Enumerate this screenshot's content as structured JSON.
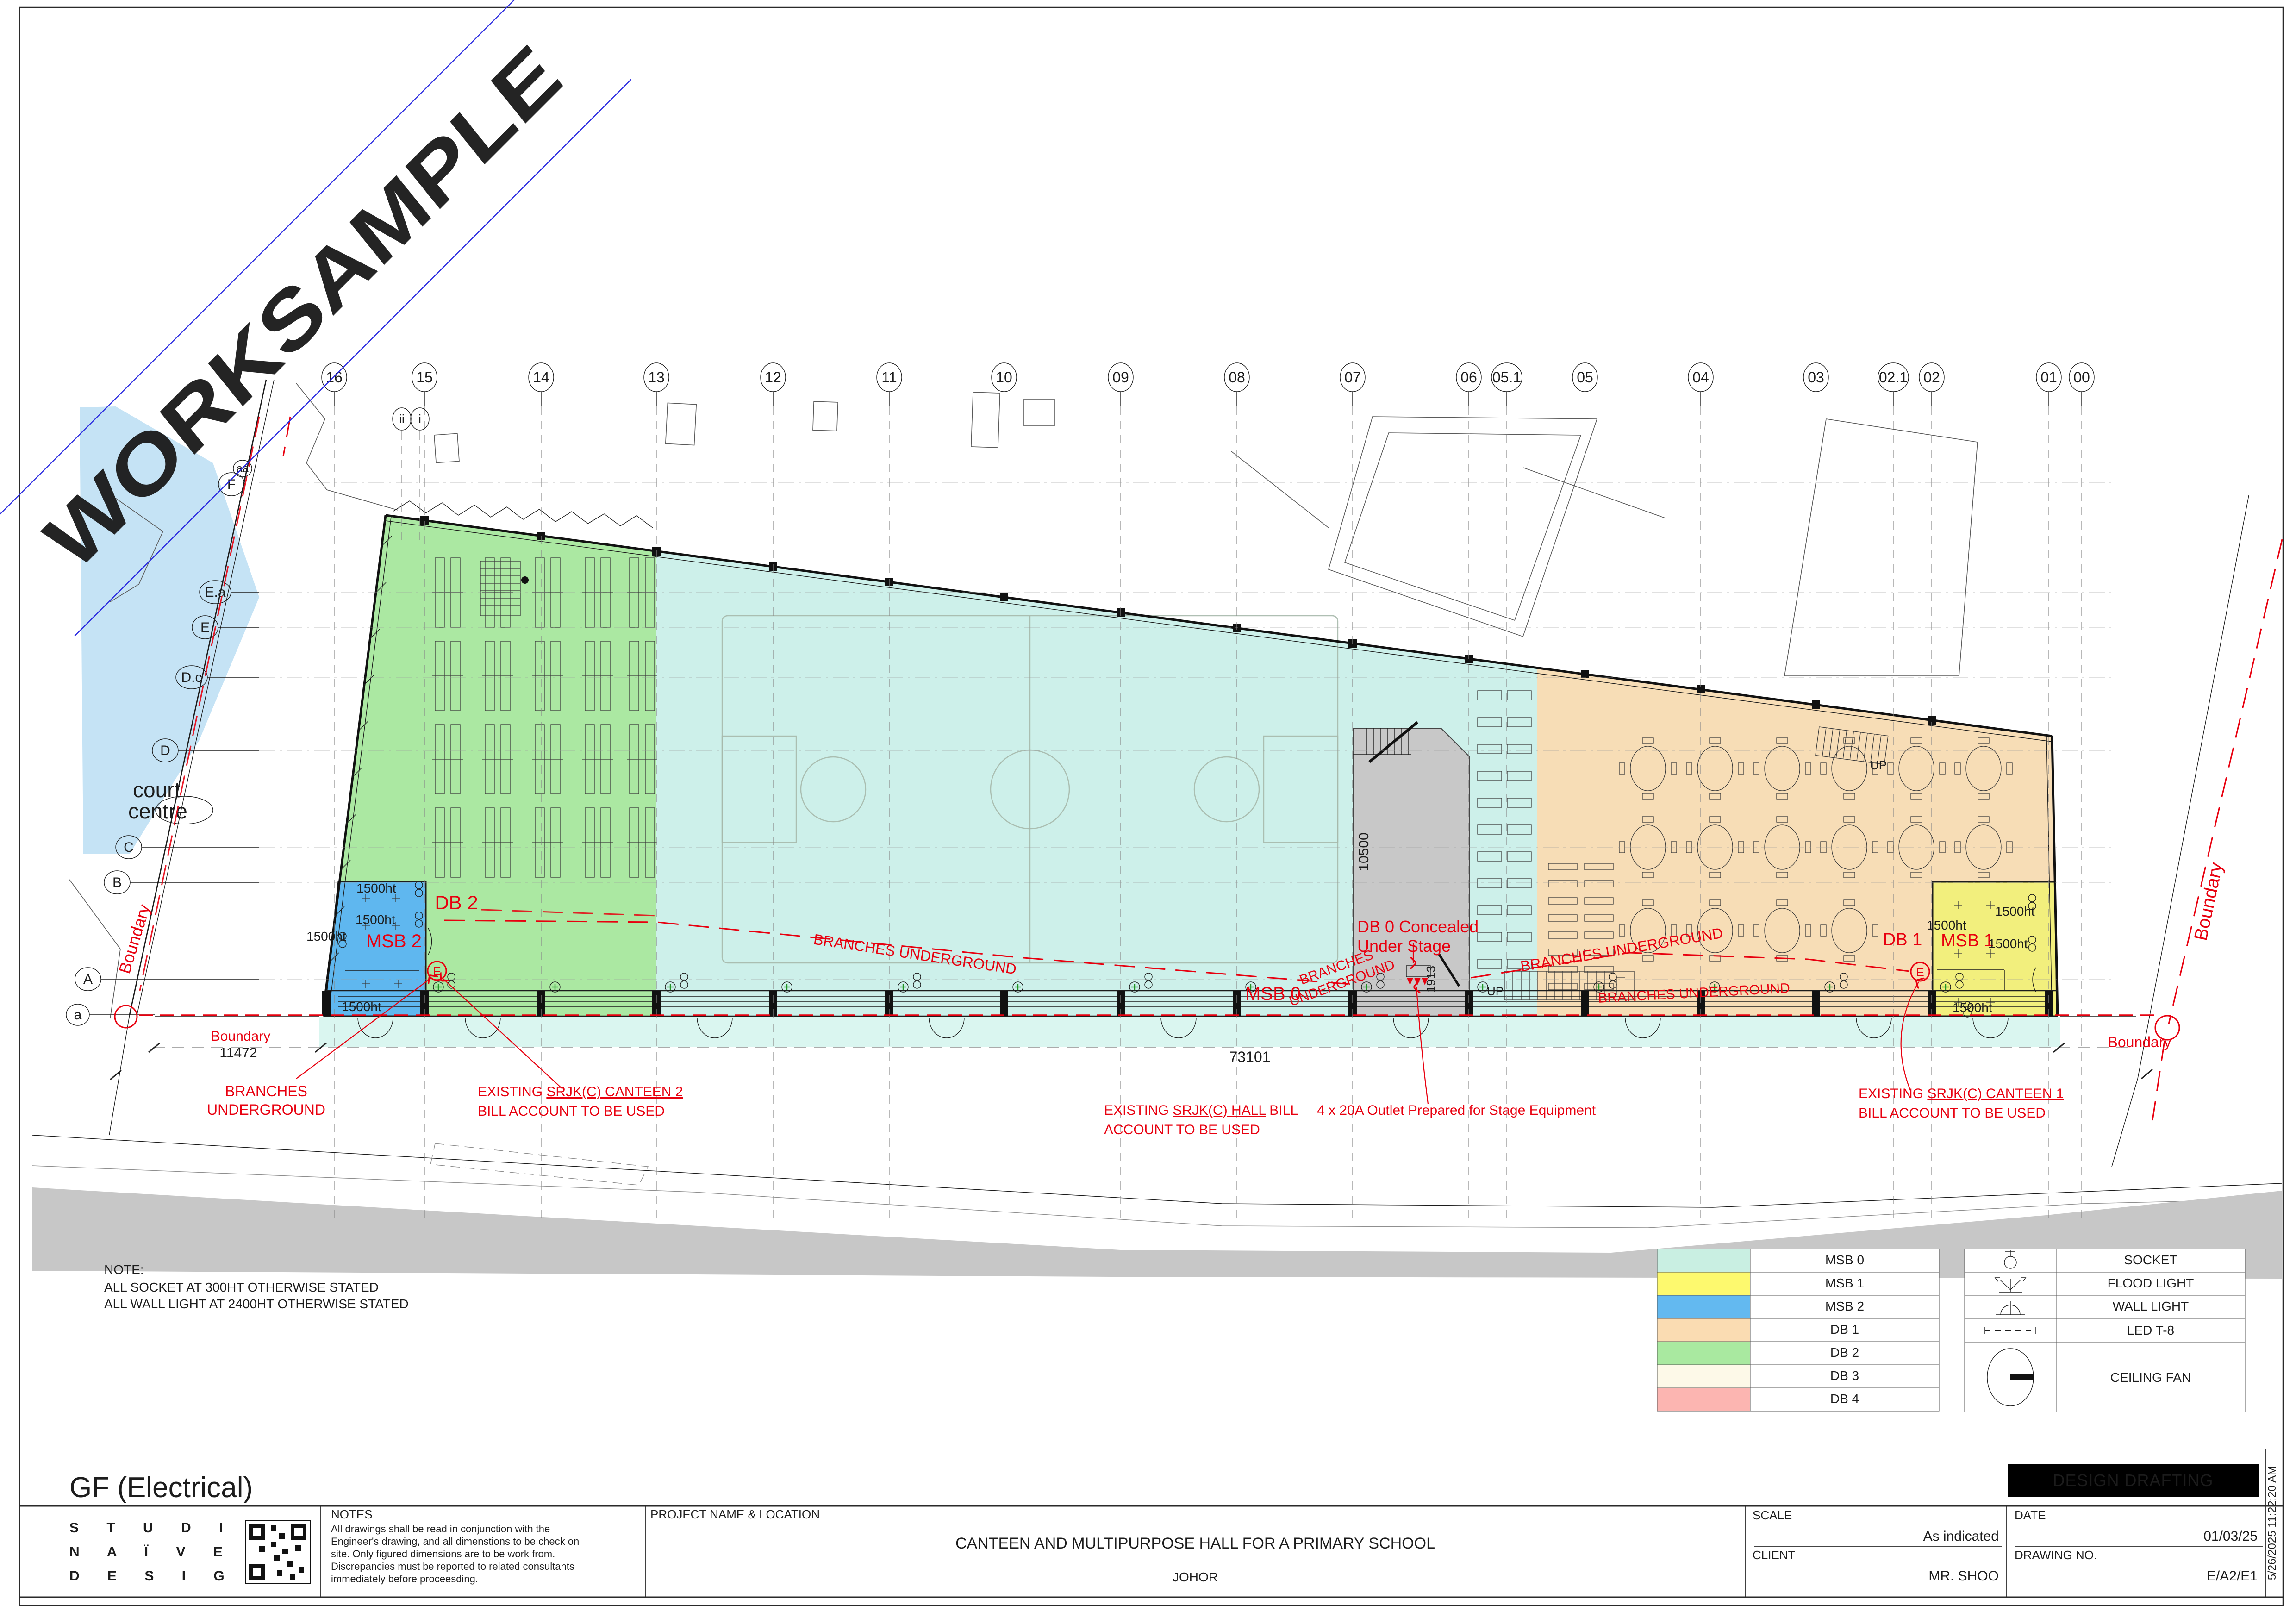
{
  "sheet": {
    "watermark": "WORKSAMPLE",
    "watermark_color": "#1a18e4"
  },
  "grid": {
    "top": [
      "16",
      "15",
      "14",
      "13",
      "12",
      "11",
      "10",
      "09",
      "08",
      "07",
      "06",
      "05.1",
      "05",
      "04",
      "03",
      "02.1",
      "02",
      "01",
      "00"
    ],
    "sub": [
      "ii",
      "i"
    ],
    "left": [
      "aa",
      "F",
      "E.a",
      "E",
      "D.c",
      "D",
      "C",
      "B",
      "A",
      "a"
    ]
  },
  "plan": {
    "labels": {
      "court1": "court",
      "court2": "centre",
      "up": "UP"
    },
    "red": {
      "db2": "DB 2",
      "msb2": "MSB 2",
      "msb0": "MSB 0",
      "db1": "DB 1",
      "msb1": "MSB 1",
      "db0_1": "DB 0 Concealed",
      "db0_2": "Under Stage",
      "branches": "BRANCHES UNDERGROUND",
      "branches1": "BRANCHES",
      "branches2": "UNDERGROUND",
      "boundary": "Boundary",
      "outlet": "4 x 20A Outlet Prepared for Stage Equipment",
      "canteen2_pre": "EXISTING ",
      "canteen2_u": "SRJK(C) CANTEEN 2",
      "canteen2_2": "BILL ACCOUNT TO BE USED",
      "hall_pre": "EXISTING ",
      "hall_u": "SRJK(C) HALL",
      "hall_post": " BILL",
      "hall_2": "ACCOUNT TO BE USED",
      "canteen1_pre": "EXISTING ",
      "canteen1_u": "SRJK(C) CANTEEN 1",
      "canteen1_2": "BILL ACCOUNT TO BE USED"
    },
    "dims": {
      "d11472": "11472",
      "d73101": "73101",
      "d10500": "10500",
      "d1913": "1913",
      "ht1500": "1500ht"
    }
  },
  "note": {
    "header": "NOTE:",
    "line1": "ALL SOCKET AT 300HT OTHERWISE STATED",
    "line2": "ALL WALL LIGHT AT 2400HT OTHERWISE STATED"
  },
  "legend": {
    "zones": [
      {
        "label": "MSB 0",
        "color": "#c9efe2"
      },
      {
        "label": "MSB 1",
        "color": "#fdf96e"
      },
      {
        "label": "MSB 2",
        "color": "#63b9f0"
      },
      {
        "label": "DB 1",
        "color": "#fadcb2"
      },
      {
        "label": "DB 2",
        "color": "#a9e9a0"
      },
      {
        "label": "DB 3",
        "color": "#fdf9e8"
      },
      {
        "label": "DB 4",
        "color": "#fcb5b1"
      }
    ],
    "symbols": [
      {
        "icon": "socket-icon",
        "label": "SOCKET"
      },
      {
        "icon": "flood-light-icon",
        "label": "FLOOD LIGHT"
      },
      {
        "icon": "wall-light-icon",
        "label": "WALL LIGHT"
      },
      {
        "icon": "led-t8-icon",
        "label": "LED T-8"
      },
      {
        "icon": "ceiling-fan-icon",
        "label": "CEILING FAN"
      }
    ]
  },
  "titleblock": {
    "sheet_title": "GF (Electrical)",
    "studio1": "S T U D I O",
    "studio2": "N A Ï V E",
    "studio3": "D E S I G N",
    "notes_header": "NOTES",
    "notes": [
      "All drawings shall be read in conjunction with the",
      "Engineer's drawing, and all dimenstions to be check on",
      "site. Only figured dimensions are to be work from.",
      "Discrepancies must be reported to related consultants",
      "immediately before proceesding."
    ],
    "project_header": "PROJECT NAME & LOCATION",
    "project_name": "CANTEEN AND MULTIPURPOSE HALL FOR A PRIMARY SCHOOL",
    "location": "JOHOR",
    "scale_label": "SCALE",
    "scale_value": "As indicated",
    "client_label": "CLIENT",
    "client_value": "MR. SHOO",
    "date_label": "DATE",
    "date_value": "01/03/25",
    "dwg_label": "DRAWING NO.",
    "dwg_value": "E/A2/E1",
    "stamp": "DESIGN DRAFTING",
    "timestamp": "5/26/2025 11:22:20 AM"
  }
}
